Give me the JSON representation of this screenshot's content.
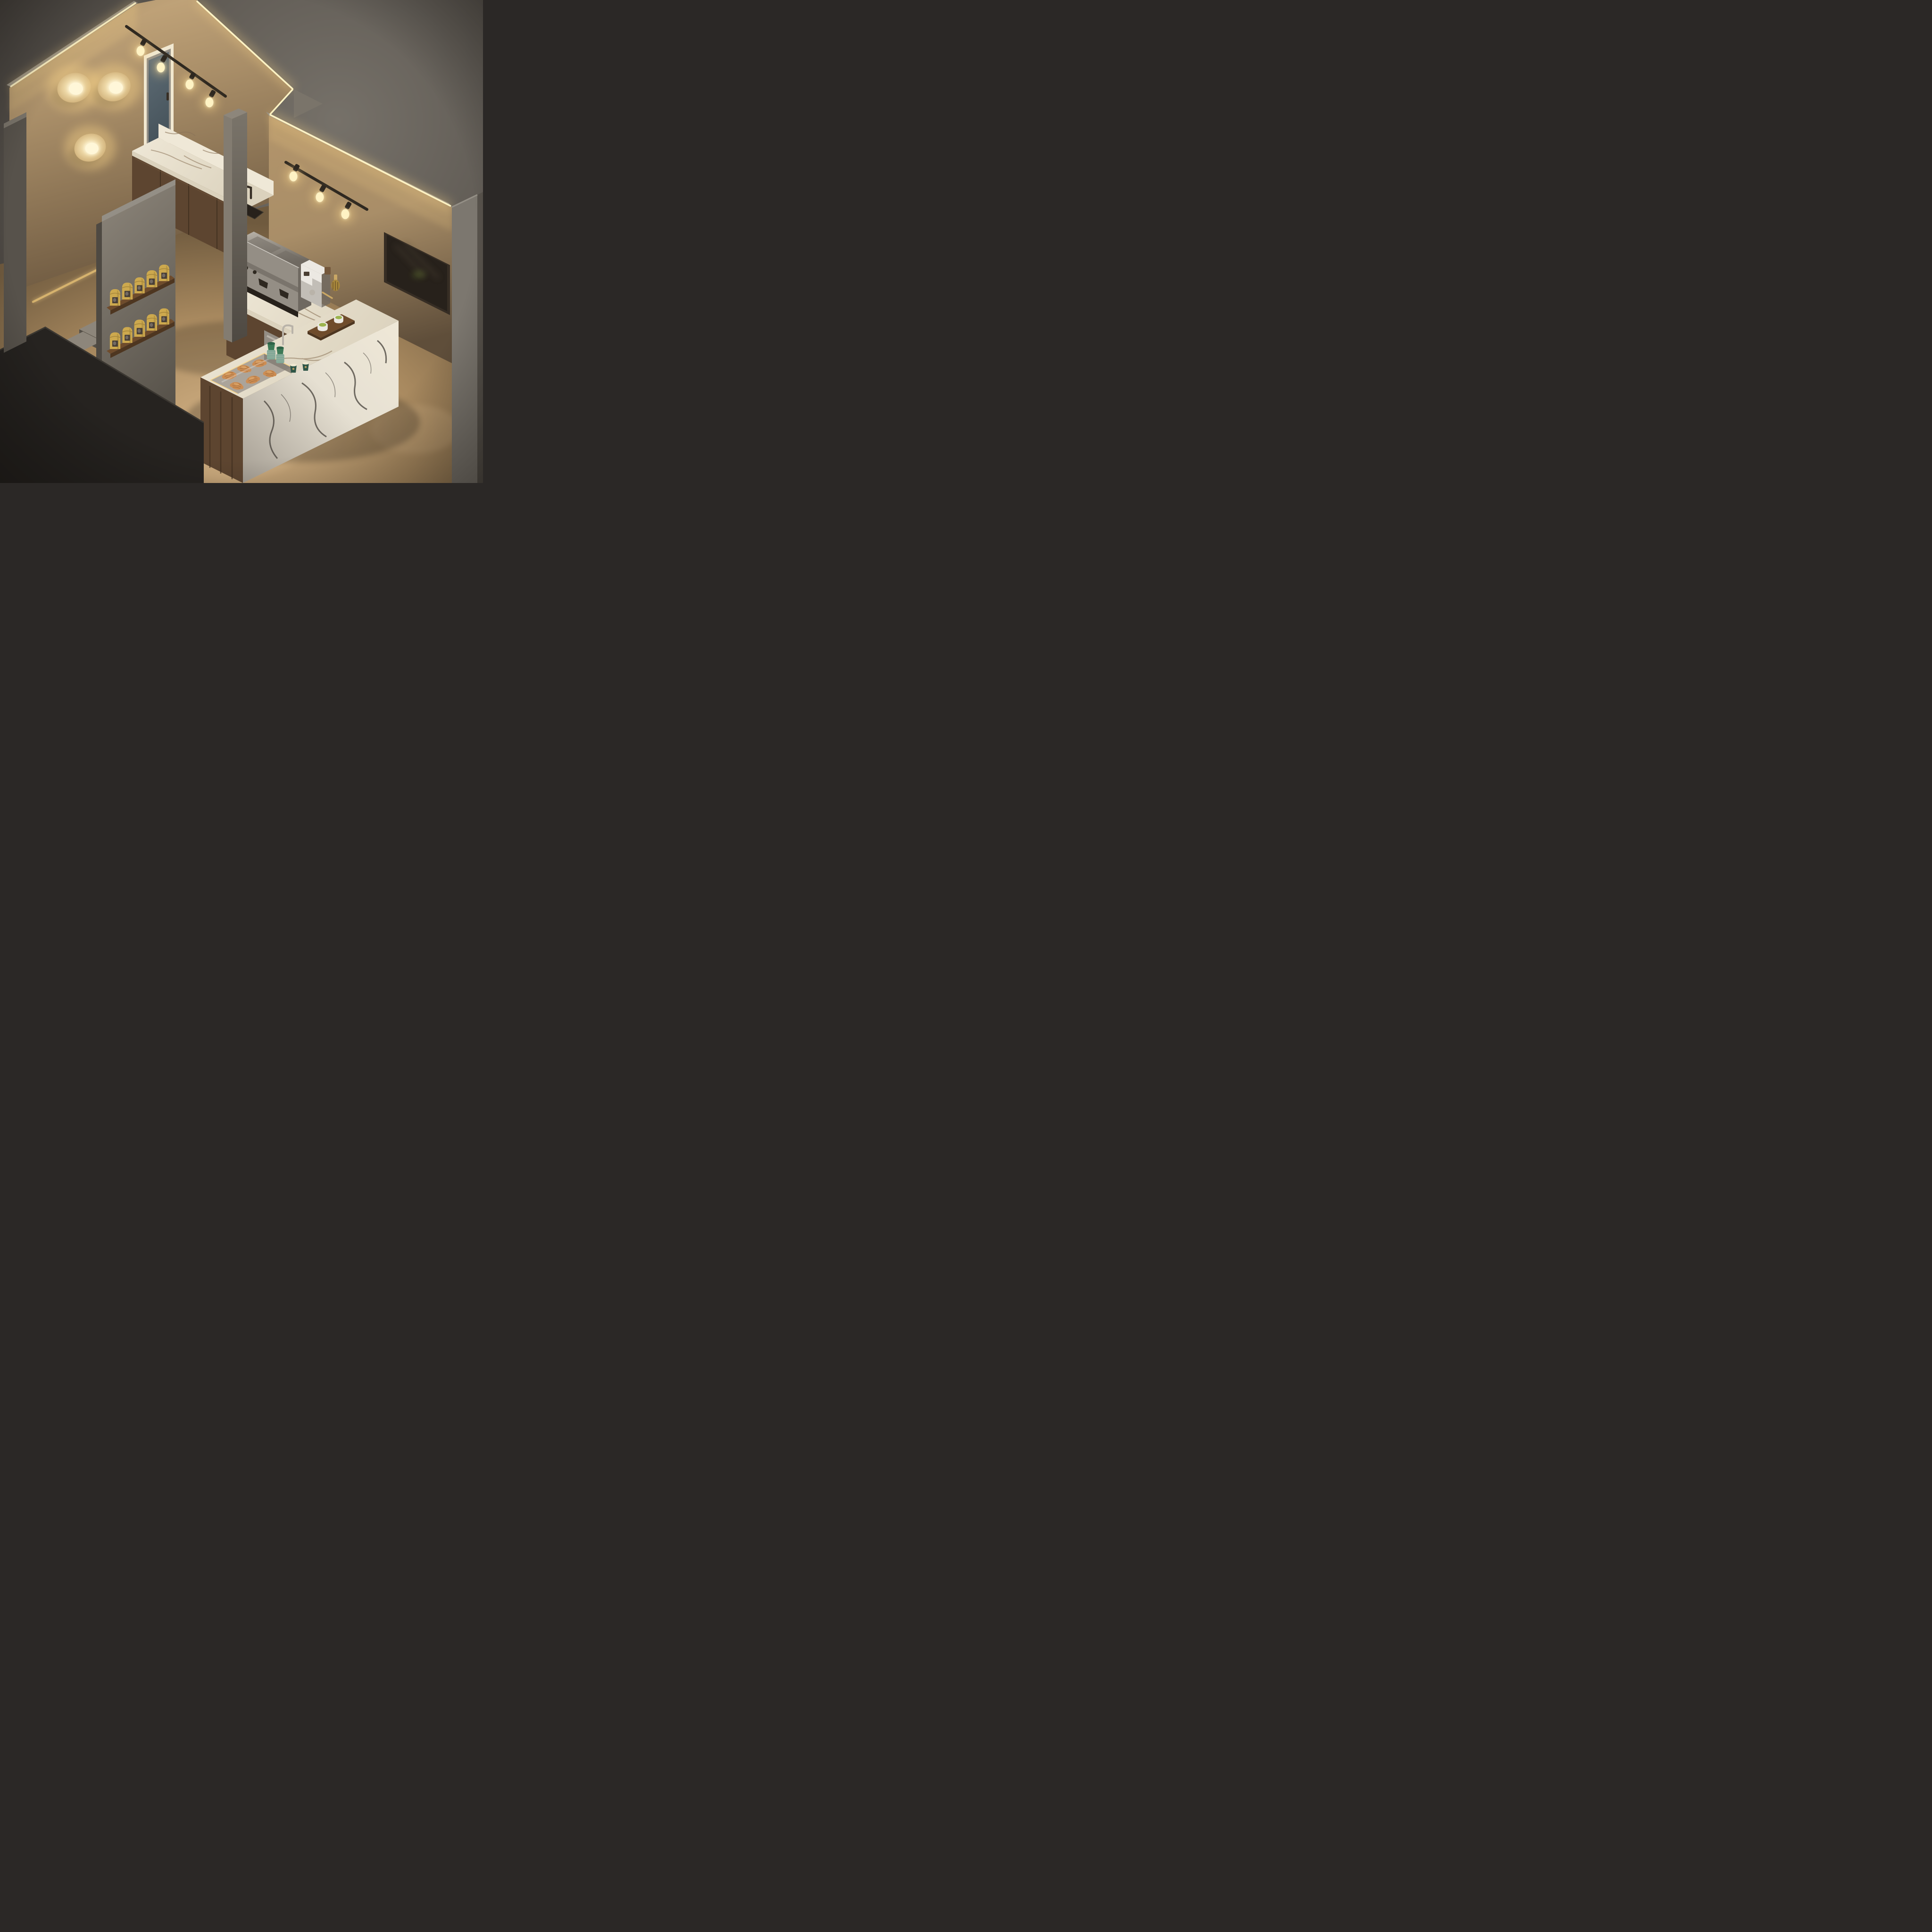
{
  "meta": {
    "title": "Isometric café interior — night render",
    "description": "Cutaway isometric 3D render of a small specialty coffee and matcha bar with warm cove lighting, marble counters, walnut cabinetry, pastry case, coffee-bag shelves, concrete stairs and a dark menu screen.",
    "source_resolution": "4096x4096"
  },
  "palette": {
    "bgDark": "#3f3b37",
    "bgMid": "#57524c",
    "bgLight": "#767169",
    "outerWallGray": "#7c776f",
    "outerWallDark": "#57524b",
    "outerFloorGray": "#6e6963",
    "wallTopGray": "#948f86",
    "wallWarmBright": "#c9ab7f",
    "wallWarm": "#a98e68",
    "wallWarmDeep": "#6b573f",
    "wallWarm2": "#b2946a",
    "wallWarm2Deep": "#5f4e3a",
    "ledCore": "#fff3c4",
    "ledGlow": "#ffd98a",
    "lampDisc": "#ecd6a4",
    "lampDiscEdge": "#c9a76e",
    "lampCore": "#fff7d9",
    "concrete": "#7a746a",
    "concreteLit": "#8d867b",
    "concreteDark": "#555048",
    "pillarLit": "#837c71",
    "pillarDark": "#4e4942",
    "cutWallDark": "#262320",
    "cutWallEdge": "#3b3731",
    "floorTan": "#a8895f",
    "floorPool": "#d2b184",
    "floorShadow": "#6f5a3e",
    "marbleLight": "#efe8d7",
    "marbleMid": "#dbd2bd",
    "marbleShadow": "#a49d92",
    "marbleFaceLight": "#e6e0d2",
    "veinWarm": "#8a7358",
    "veinDark": "#46403a",
    "walnut": "#5d4530",
    "walnutDark": "#3f2e1e",
    "walnutLight": "#74583c",
    "steel": "#b9b3a9",
    "steelDark": "#6f6961",
    "steelPanel": "#948e85",
    "white": "#ece9e3",
    "whiteShade": "#c2beb7",
    "matchaGreen": "#9cb44e",
    "matchaDeep": "#7a9a3a",
    "cupGreen": "#3e7a57",
    "cupGreenDark": "#2e6246",
    "cupSleeve": "#83a997",
    "paperCupTeal": "#2e5547",
    "creamRim": "#f1e8d1",
    "bagYellow": "#cda94e",
    "bagYellowDark": "#a8883c",
    "bagWindow": "#4a4037",
    "shelfWood": "#6f4c2c",
    "shelfWoodDark": "#4e3620",
    "croissant": "#c98445",
    "croissantLight": "#e2a866",
    "croissantDark": "#8f5a26",
    "brass": "#c9a765",
    "glassBlue": "#5f6d76",
    "glassBlueDark": "#47545c",
    "tvFrame": "#362d24",
    "tvScreen": "#27211b",
    "tvSheen": "#4a3f33",
    "trackBlack": "#2e2820",
    "shadowBlack": "#000000"
  },
  "objects": {
    "wall_lamps": {
      "label": "round disc wall sconces, lit",
      "count": 3
    },
    "led_cove": {
      "label": "warm LED strip along cutaway wall tops",
      "segments": 4
    },
    "track_light_left": {
      "label": "black track light over mirror",
      "bulbs": 4
    },
    "track_light_right": {
      "label": "black track light on right wall",
      "bulbs": 3
    },
    "mirror_window": {
      "label": "tall wood-framed mirror window with blue-grey glass"
    },
    "back_counter": {
      "label": "walnut cabinets, calacatta marble top and backsplash"
    },
    "sink": {
      "label": "black undermount sink with black faucet"
    },
    "espresso_machine": {
      "label": "stainless two-group espresso machine"
    },
    "matcha_dispenser": {
      "label": "white countertop matcha dispenser"
    },
    "matcha_whisk": {
      "label": "bamboo chasen whisk and scoop"
    },
    "under_counter_fridge": {
      "label": "stainless under-counter fridge"
    },
    "island_counter": {
      "label": "L-shaped calacatta-viola marble service counter"
    },
    "pastry_case": {
      "label": "recessed glass pastry case",
      "contents": "croissants",
      "croissant_count": 6
    },
    "cup_stacks": {
      "label": "stacked green reusable cups",
      "stacks": 2
    },
    "paper_cups": {
      "label": "dark-green paper cups with gold crest",
      "count": 2
    },
    "matcha_tray": {
      "label": "walnut tray with matcha bowls",
      "bowls": 2
    },
    "glass_rinser_faucet": {
      "label": "chrome gooseneck rinser on island"
    },
    "shelf_wall": {
      "label": "concrete partition with walnut shelves",
      "shelves": 2
    },
    "coffee_bags": {
      "label": "kraft coffee-bean bags with window",
      "per_shelf": 5,
      "total": 10
    },
    "stairs": {
      "label": "concrete staircase",
      "visible_steps": 4,
      "handrail": "brass"
    },
    "menu_screen": {
      "label": "dark wall-mounted menu screen"
    },
    "pillar": {
      "label": "concrete structural pillar"
    }
  }
}
